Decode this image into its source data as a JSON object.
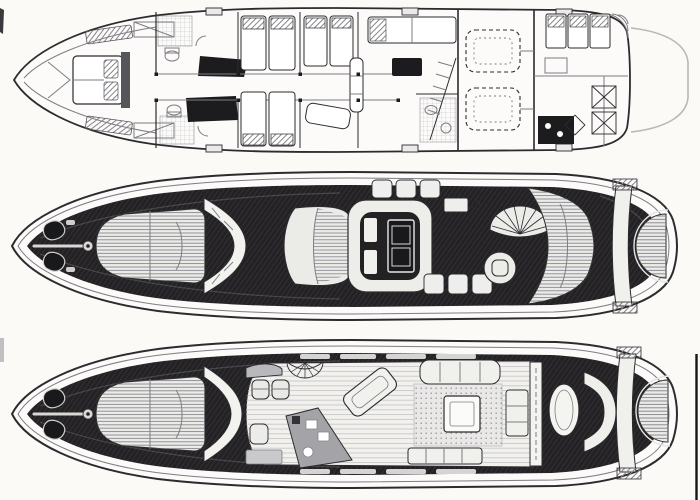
{
  "page": {
    "background": "#fbfaf7"
  },
  "colors": {
    "paper": "#fcfbf9",
    "ink": "#2c2b2e",
    "line_soft": "#7d7d84",
    "deck_dark": "#232124",
    "pad_light": "#ebebe8",
    "counter_gray": "#a4a4a8",
    "platform_line": "#b8b8b4",
    "floor_light": "#f2f1ee",
    "edge_mark": "#1c1c1e"
  },
  "diagram": {
    "kind": "yacht-deck-plans",
    "orientation": "bow-left",
    "views": [
      {
        "id": "lower-deck-accommodation-plan",
        "features": [
          "vip-cabin-bed",
          "en-suite-heads",
          "twin-guest-berths",
          "midship-cabin",
          "stairs",
          "engine-room-twin-engines",
          "crew-bunks",
          "galley",
          "swim-platform"
        ]
      },
      {
        "id": "flybridge-deck-plan",
        "features": [
          "anchor-windlass",
          "bow-sunpad",
          "windshield",
          "u-settee-with-table",
          "bench-seats",
          "helm-fan-seat",
          "helm-wheel-seat",
          "aft-sunpad",
          "radar-arch",
          "transom-sunpad"
        ]
      },
      {
        "id": "main-deck-plan",
        "features": [
          "anchor-windlass",
          "bow-sunpad",
          "windshield",
          "helm-seats",
          "stair-fan",
          "galley-counters",
          "chaise-lounge",
          "dinette-sofa",
          "salon-table",
          "cockpit-oval-table",
          "cockpit-bench",
          "transom-sunpad"
        ]
      }
    ]
  }
}
